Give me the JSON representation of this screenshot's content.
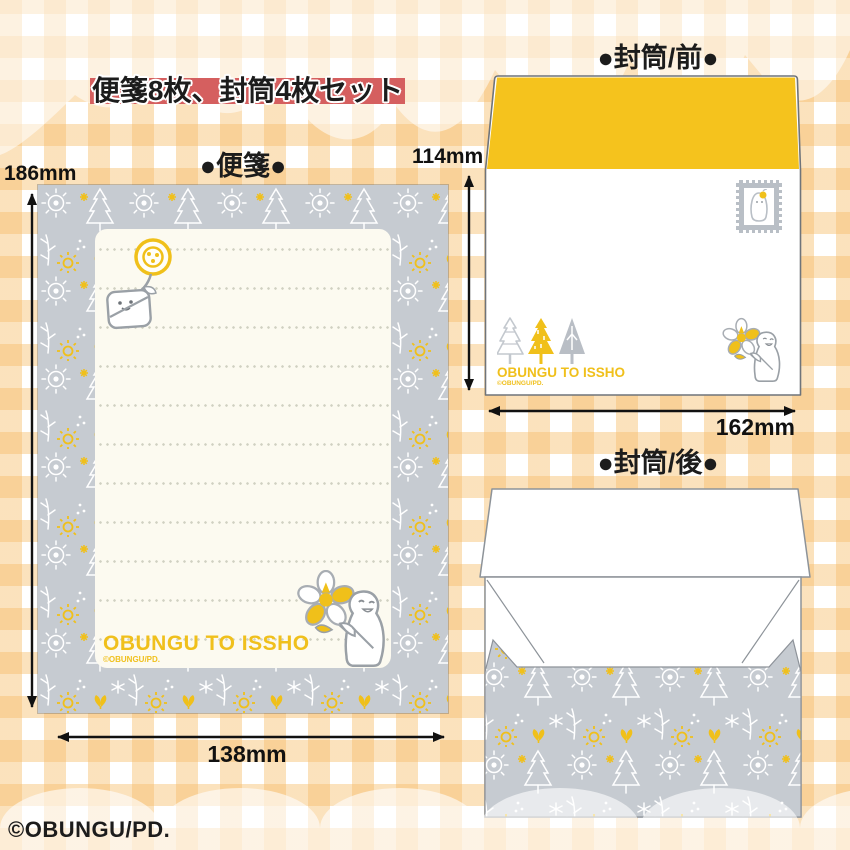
{
  "title_banner": {
    "text": "便箋8枚、封筒4枚セット"
  },
  "letter_paper": {
    "section_label": "●便箋●",
    "height_label": "186mm",
    "width_label": "138mm",
    "brand_text": "OBUNGU TO ISSHO",
    "brand_copyright": "©OBUNGU/PD."
  },
  "envelope_front": {
    "section_label": "●封筒/前●",
    "height_label": "114mm",
    "width_label": "162mm",
    "brand_text": "OBUNGU TO ISSHO",
    "brand_copyright": "©OBUNGU/PD."
  },
  "envelope_back": {
    "section_label": "●封筒/後●"
  },
  "footer": {
    "copyright": "©OBUNGU/PD."
  },
  "icons": {
    "stamp": "postage-stamp-icon",
    "trees": "three-trees-icon",
    "characters": [
      "button-flower-character",
      "ghost-flower-character",
      "stamp-bird-character"
    ],
    "pattern_motifs": [
      "flower",
      "pine-tree",
      "sprout",
      "sparkle",
      "leaf-sprig"
    ]
  },
  "colors": {
    "banner_red": "#d55f5f",
    "accent_yellow": "#f3c01c",
    "envelope_flap_yellow": "#f5c31d",
    "pattern_gray": "#c6cbd1",
    "gingham_orange": "#f8d7a4",
    "paper_cream": "#fcfaf0",
    "outline_gray": "#9aa0a6",
    "text_black": "#1c1c1c"
  }
}
